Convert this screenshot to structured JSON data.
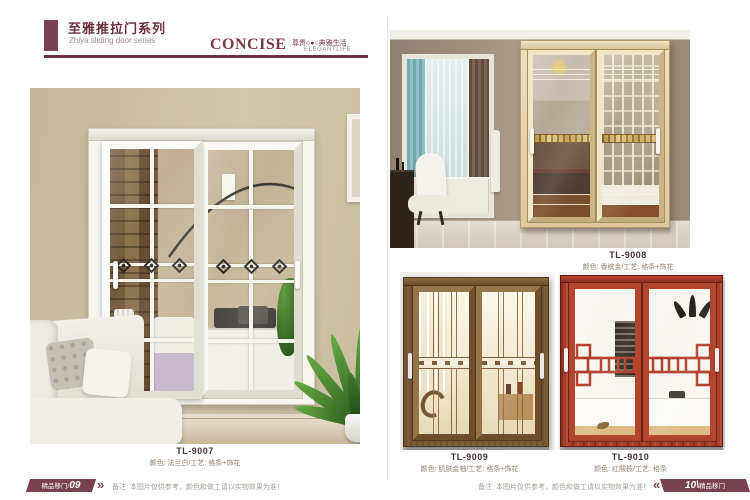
{
  "header": {
    "title_cn": "至雅推拉门系列",
    "title_en": "Zhiya sliding door series",
    "brand": "CONCISE",
    "tagline_cn": "尊贵○●○典雅生活",
    "tagline_en": "ELEGANTLIFE"
  },
  "products": [
    {
      "model": "TL-9007",
      "desc": "颜色: 法兰白/工艺: 格条+饰花"
    },
    {
      "model": "TL-9008",
      "desc": "颜色: 香槟金/工艺: 格条+饰花"
    },
    {
      "model": "TL-9009",
      "desc": "颜色: 肌肤金柚/工艺: 格条+饰花"
    },
    {
      "model": "TL-9010",
      "desc": "颜色: 红酸枝/工艺: 格条"
    }
  ],
  "footer": {
    "left_series": "精品移门/",
    "left_page": "09",
    "left_chevron": "»",
    "note_left": "备注: 本图片仅供参考，颜色和做工请以实物效果为准！",
    "note_right": "备注: 本图片仅供参考，颜色和做工请以实物效果为准！",
    "right_chevron": "«",
    "right_page": "10\\",
    "right_series": "精品移门"
  },
  "colors": {
    "accent": "#7a4150",
    "header_rule": "#6d3244"
  }
}
